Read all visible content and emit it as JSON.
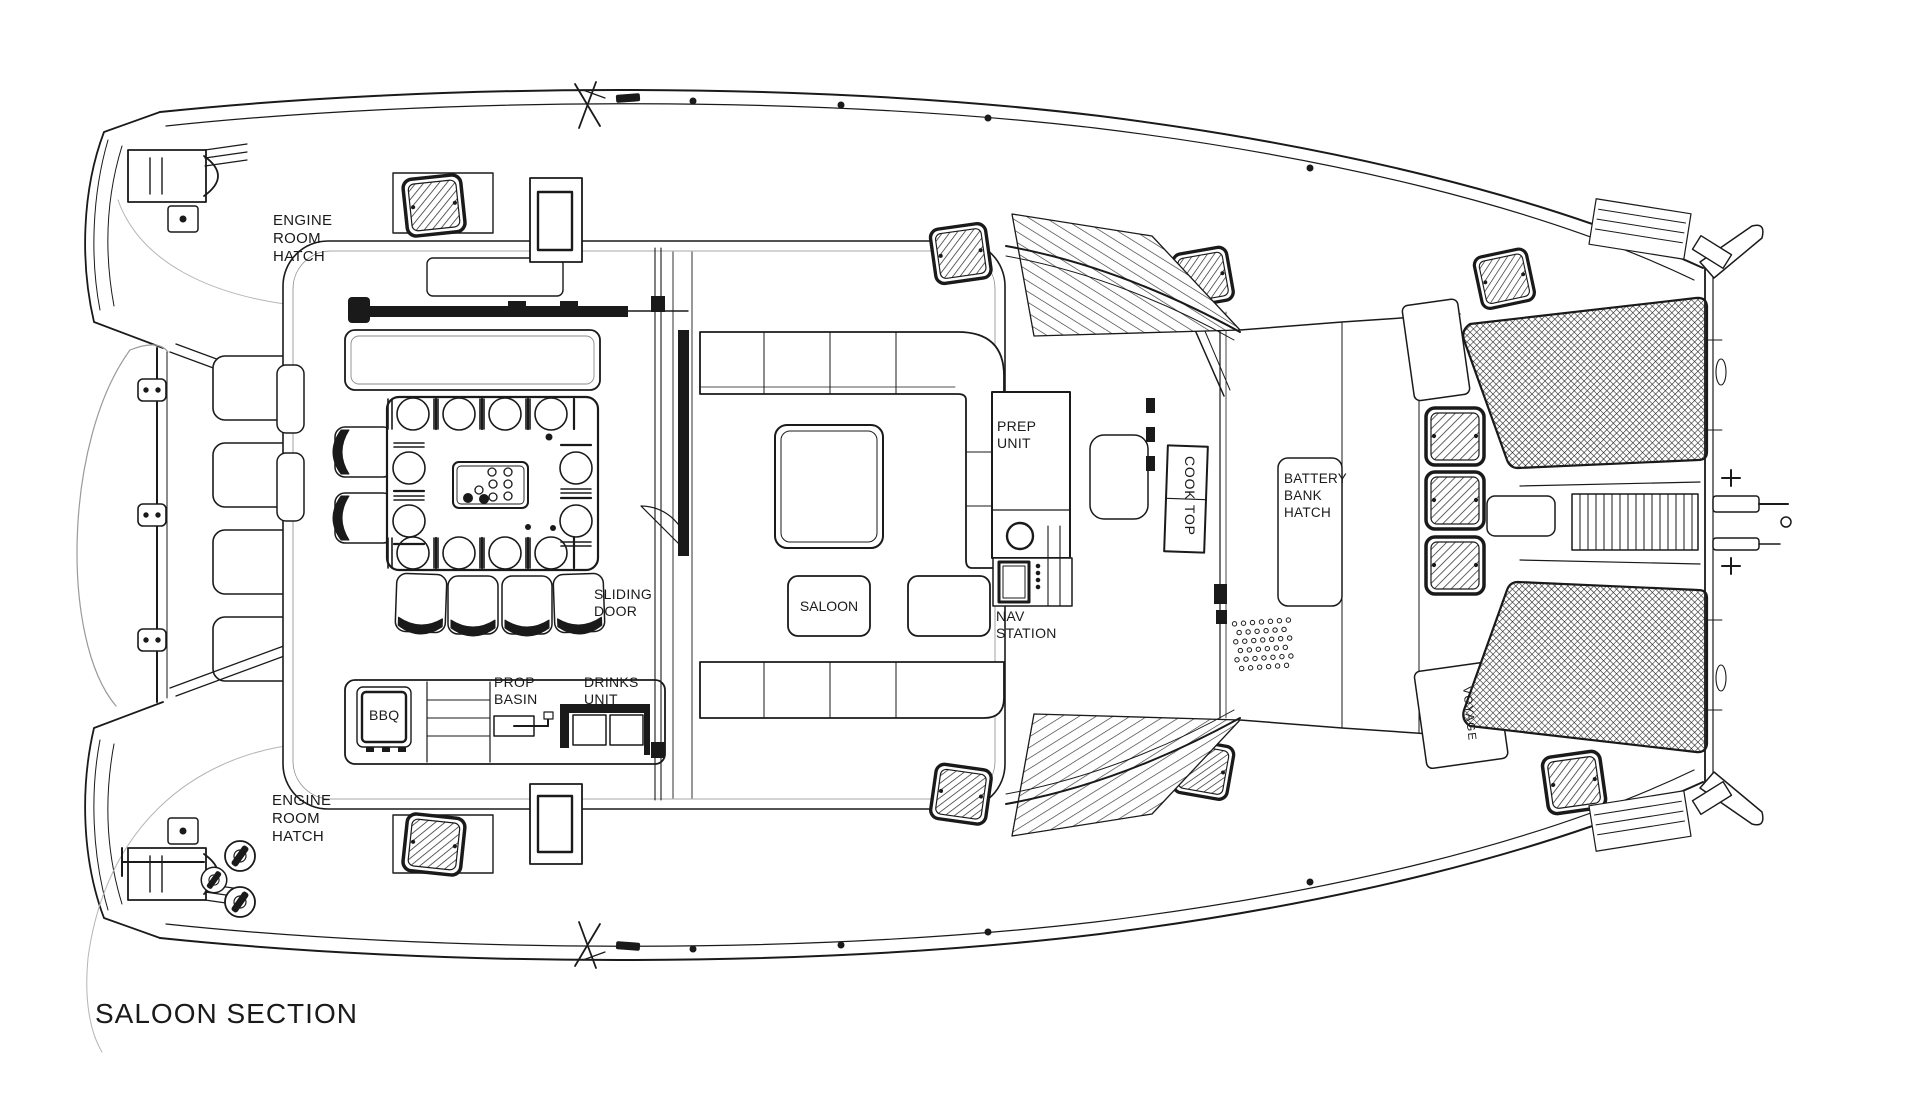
{
  "page": {
    "background": "#ffffff",
    "line_color": "#1a1a1a"
  },
  "title": "SALOON SECTION",
  "plan_labels": {
    "engine_room_hatch_port": "ENGINE\nROOM\nHATCH",
    "engine_room_hatch_starboard": "ENGINE\nROOM\nHATCH",
    "bbq": "BBQ",
    "prop_basin": "PROP\nBASIN",
    "drinks_unit": "DRINKS\nUNIT",
    "sliding_door": "SLIDING\nDOOR",
    "saloon": "SALOON",
    "prep_unit": "PREP\nUNIT",
    "nav_station": "NAV\nSTATION",
    "cook_top": "COOK TOP",
    "battery_bank_hatch": "BATTERY\nBANK\nHATCH",
    "voyage": "VOYAGE"
  }
}
